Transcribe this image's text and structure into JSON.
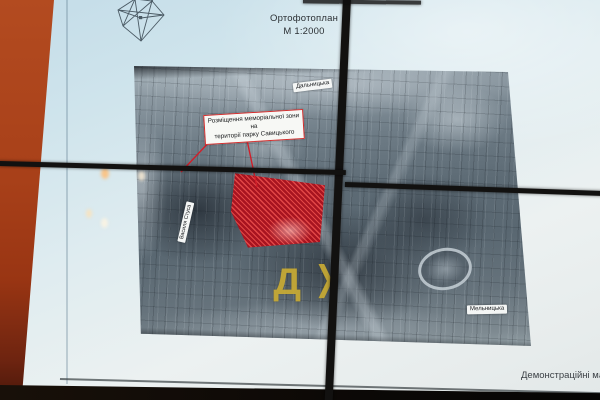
{
  "slide": {
    "title_line1": "Ортофотоплан",
    "title_line2": "М 1:2000",
    "footer_text": "Демонстраційні мате",
    "logo_icon": "wireframe-polygon-logo"
  },
  "map": {
    "annotation_line1": "Розміщення меморіальної зони на",
    "annotation_line2": "території парку Савицького",
    "street_dalnytska": "Дальницька",
    "street_melnytska": "Мельницька",
    "street_stusa": "Василя Стуса",
    "overlay_letter": "Д",
    "overlay_chevron": "❯",
    "zone_fill_color": "#c1202c",
    "zone_hatch_color": "#e64a48",
    "overlay_letter_color": "#ceb038"
  },
  "environment": {
    "wall_color": "#a84019",
    "bezel_color": "#121110",
    "screen_tint": "#cfe4ec"
  }
}
